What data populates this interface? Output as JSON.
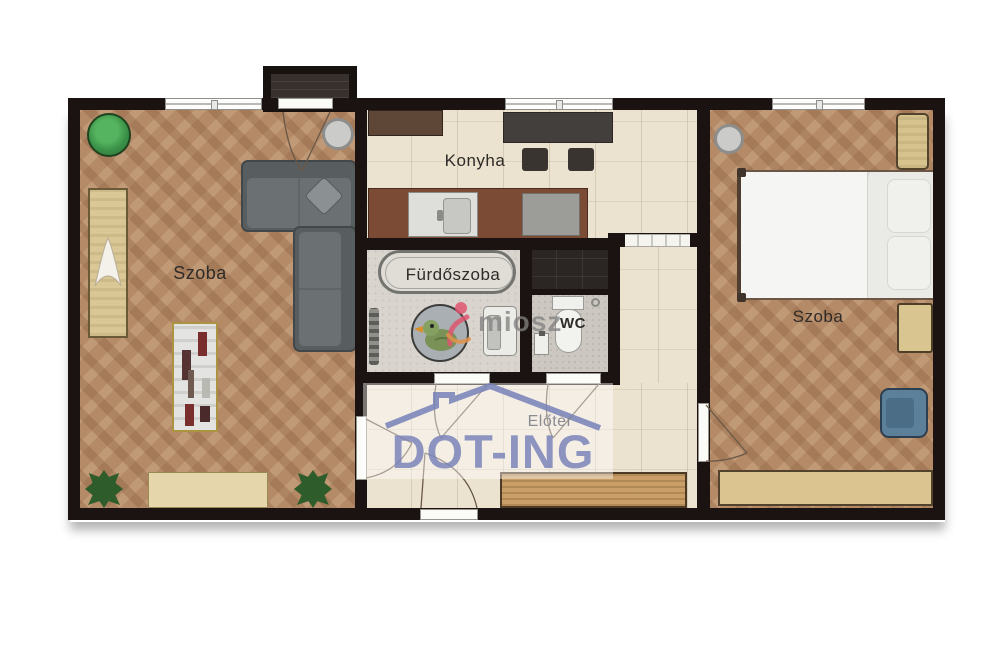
{
  "rooms": {
    "living": {
      "label": "Szoba"
    },
    "kitchen": {
      "label": "Konyha"
    },
    "bathroom": {
      "label": "Fürdőszoba"
    },
    "wc": {
      "label": "WC"
    },
    "hall": {
      "label": "Előtér"
    },
    "bedroom": {
      "label": "Szoba"
    }
  },
  "watermarks": {
    "brand": "DOT-ING",
    "association": "miosz"
  },
  "colors": {
    "wall": "#1a1311",
    "wood_floor": "#b48a67",
    "tile_floor": "#ece2d0",
    "bath_floor": "#d9d5ce",
    "brand_blue": "#7a84bf",
    "association_pink": "#e0566f",
    "plant_green": "#3fa34d"
  },
  "furniture_icons": [
    "balcony",
    "corner-sofa",
    "floor-lamp",
    "potted-plant",
    "wall-unit",
    "bookshelf",
    "sideboard",
    "kitchen-cabinet",
    "dining-table",
    "chair",
    "kitchen-counter",
    "sink",
    "stove",
    "bathtub",
    "radiator",
    "duck-bath-mat",
    "washing-machine",
    "toilet",
    "hand-basin",
    "double-bed",
    "nightstand",
    "shelf",
    "armchair",
    "wardrobe",
    "entry-door",
    "interior-door",
    "window"
  ]
}
